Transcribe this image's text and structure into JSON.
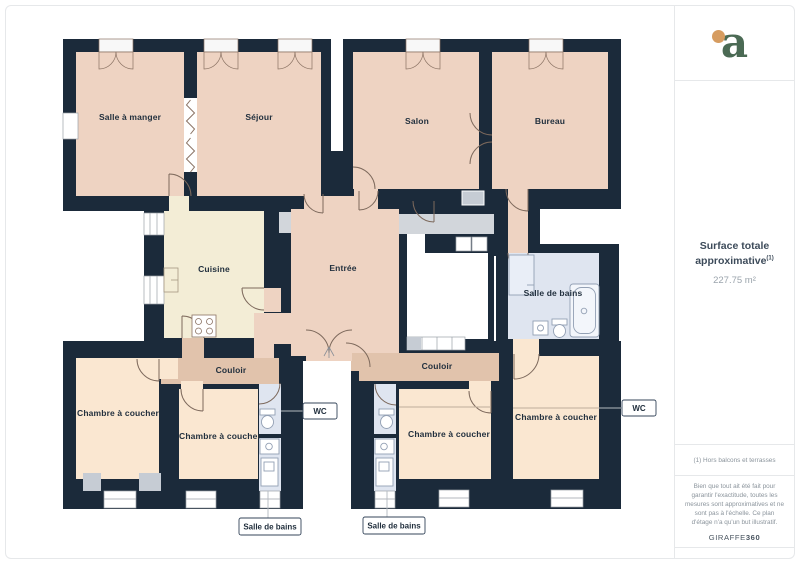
{
  "sidebar": {
    "logo_letter": "a",
    "surface_title_line1": "Surface totale",
    "surface_title_line2": "approximative",
    "surface_note_ref": "(1)",
    "surface_value": "227.75 m²",
    "footnote": "(1) Hors balcons et terrasses",
    "disclaimer": "Bien que tout ait été fait pour garantir l'exactitude, toutes les mesures sont approximatives et ne sont pas à l'échelle. Ce plan d'étage n'a qu'un but illustratif.",
    "brand_name": "GIRAFFE",
    "brand_number": "360"
  },
  "floorplan": {
    "labels": {
      "salle_a_manger": "Salle à manger",
      "sejour": "Séjour",
      "salon": "Salon",
      "bureau": "Bureau",
      "cuisine": "Cuisine",
      "entree": "Entrée",
      "salle_de_bains": "Salle de bains",
      "couloir_left": "Couloir",
      "couloir_right": "Couloir",
      "chambre_1": "Chambre à coucher",
      "chambre_2": "Chambre à coucher",
      "chambre_3": "Chambre à coucher",
      "chambre_4": "Chambre à coucher",
      "wc_left": "WC",
      "wc_right": "WC",
      "salle_de_bains_left": "Salle de bains",
      "salle_de_bains_right": "Salle de bains"
    },
    "colors": {
      "wall": "#1b2a3a",
      "room_peach": "#eed3c2",
      "room_light_peach": "#fae7d1",
      "room_tan": "#e1c3ac",
      "room_cream": "#f3edd6",
      "room_blue": "#dfe5f0",
      "passage_gray": "#d2d6db",
      "logo_green": "#4b6a54",
      "logo_orange": "#d69c60"
    }
  }
}
